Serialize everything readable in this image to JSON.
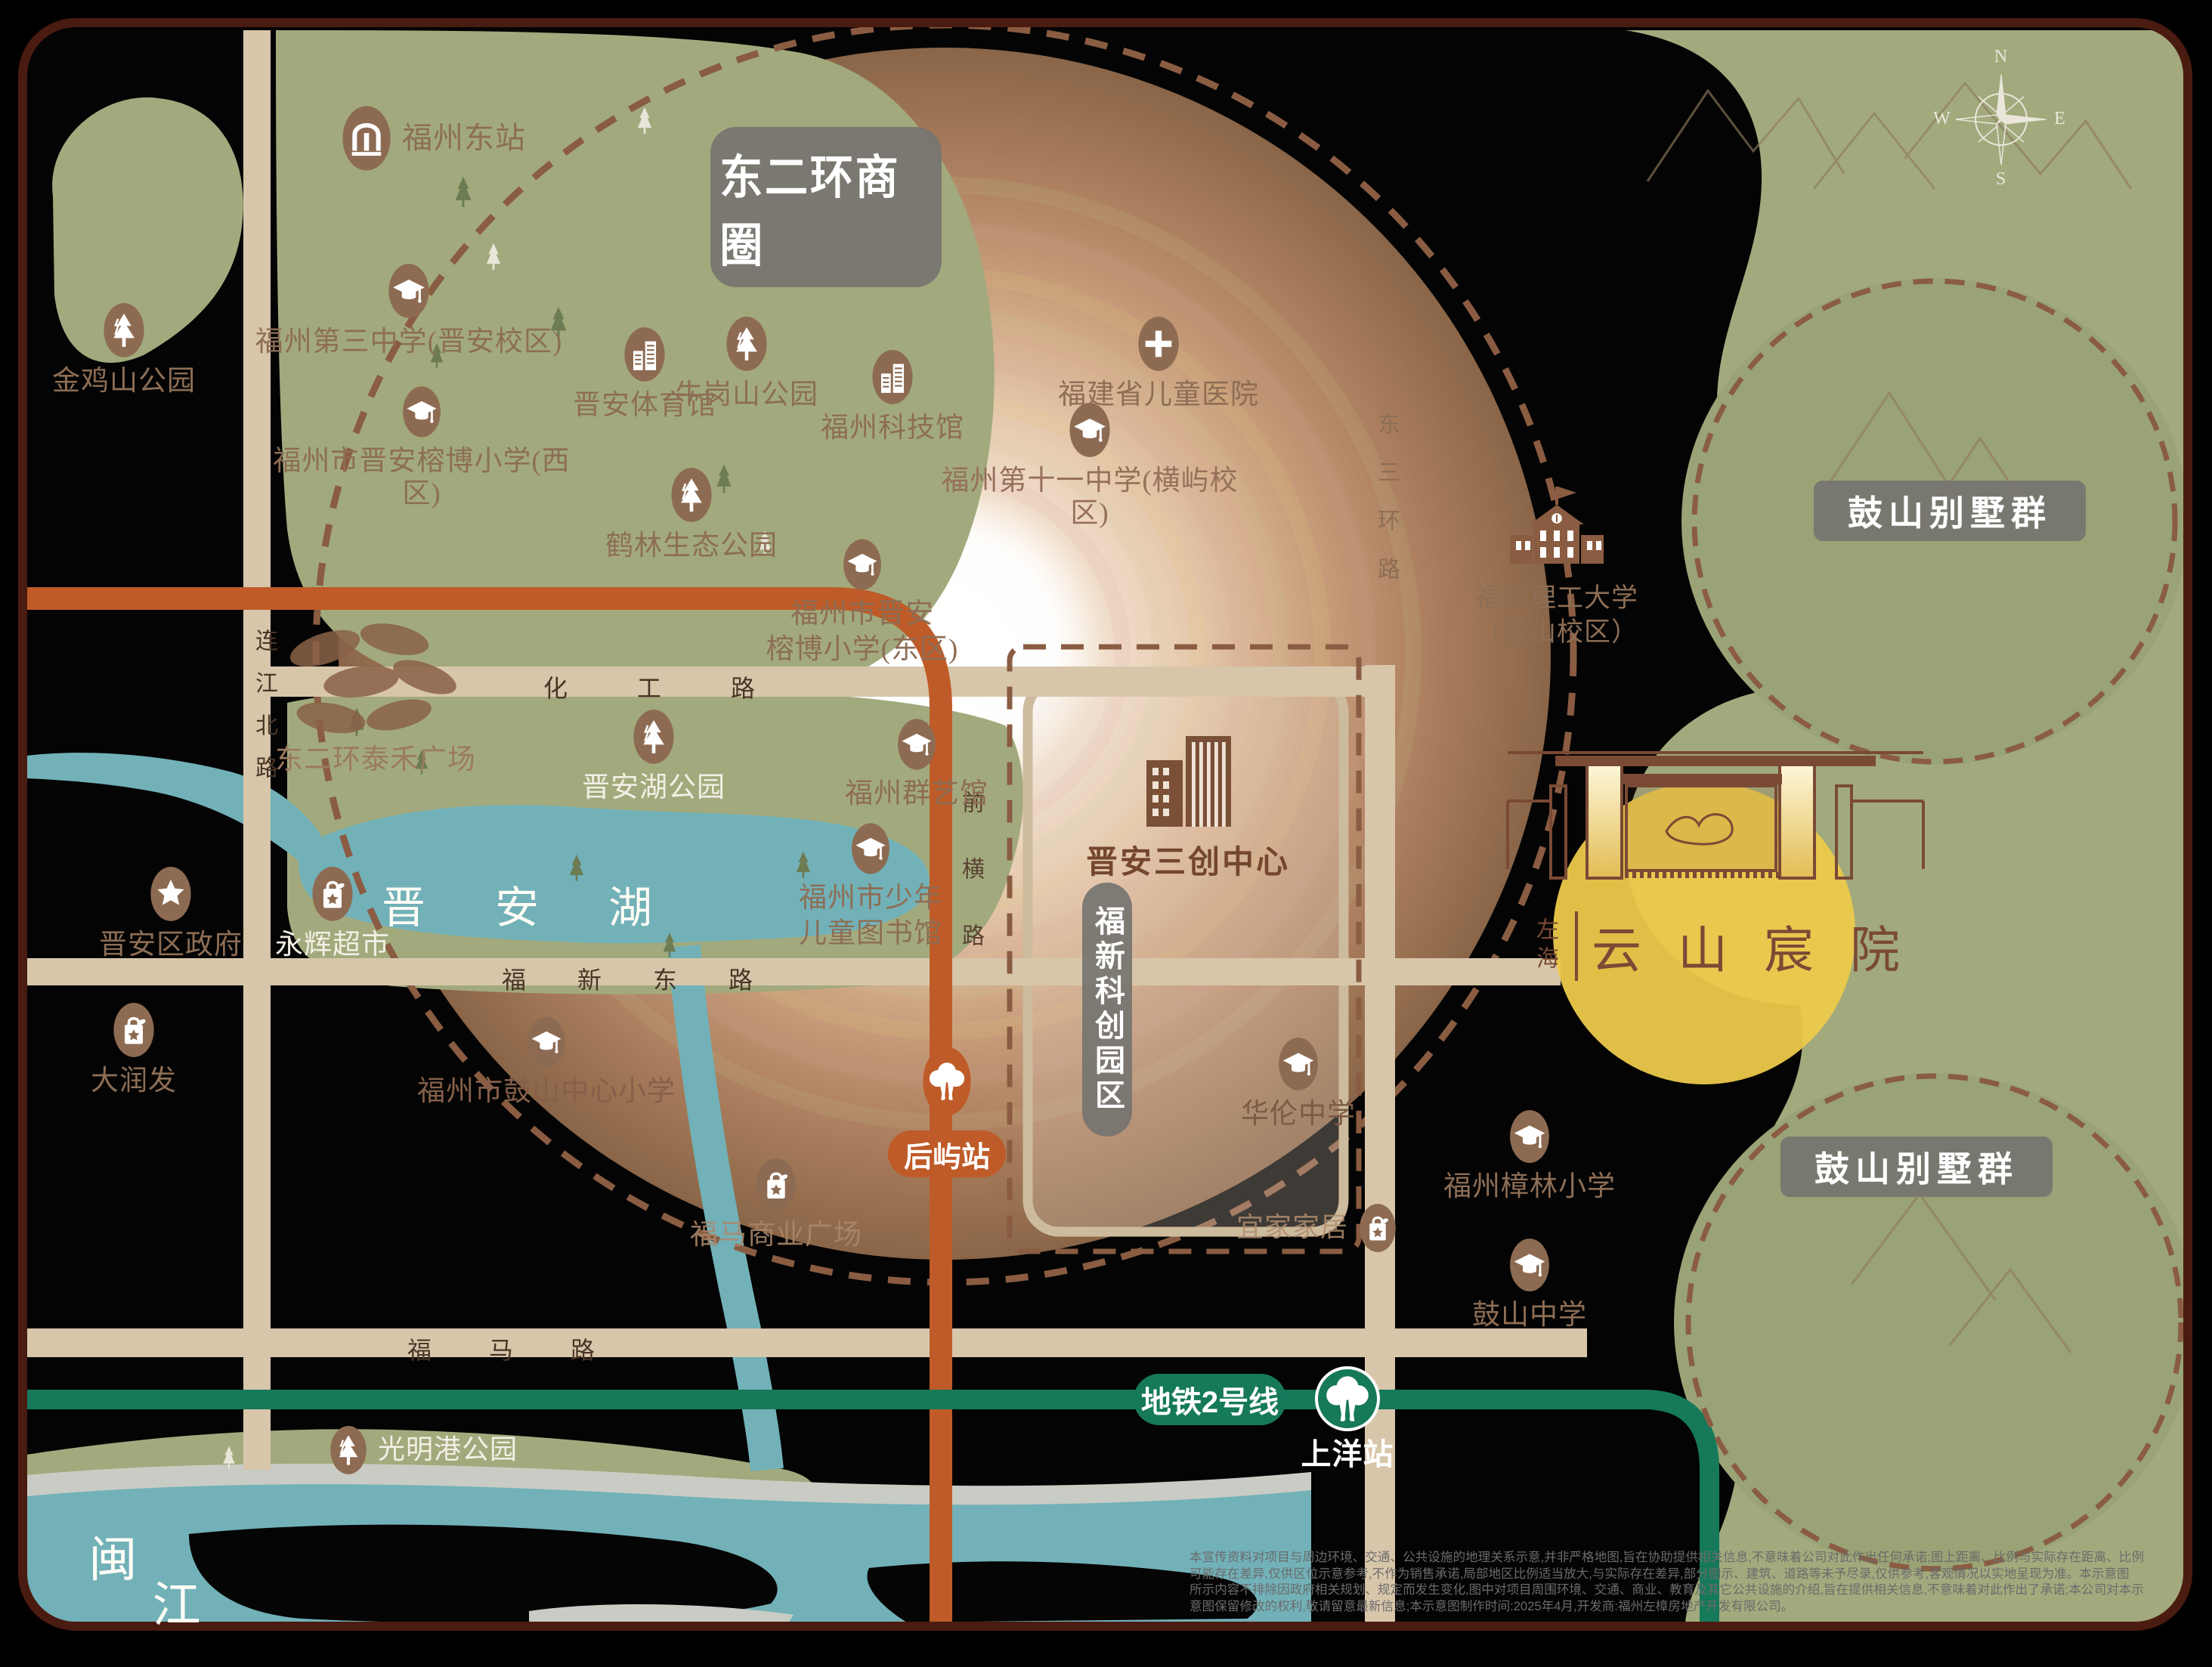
{
  "map": {
    "project": {
      "brand": "左海",
      "name": "云山宸院"
    },
    "badges": {
      "business_circle": "东二环商圈",
      "villas_top": "鼓山别墅群",
      "villas_bottom": "鼓山别墅群",
      "science_park_vertical": "福新科创园区",
      "metro_line": "地铁2号线"
    },
    "stations": {
      "houyu": "后屿站",
      "shangyang": "上洋站"
    },
    "water": {
      "lake": "晋安湖",
      "river_char1": "闽",
      "river_char2": "江"
    },
    "roads": {
      "lianjiang_north": "连江北路",
      "huagong": "化 工 路",
      "fuxin_east": "福 新 东 路",
      "qianheng": "前横路",
      "fuma": "福 马 路",
      "east_third_ring": "东三环路"
    },
    "landmark": {
      "sanchuang": "晋安三创中心"
    },
    "compass": {
      "n": "N",
      "e": "E",
      "s": "S",
      "w": "W"
    },
    "pois": {
      "fuzhou_east_station": {
        "label": "福州东站"
      },
      "jinjishan_park": {
        "label": "金鸡山公园"
      },
      "no3_middle_school": {
        "label": "福州第三中学(晋安校区)"
      },
      "niugangshan_park": {
        "label": "牛岗山公园"
      },
      "science_museum": {
        "label": "福州科技馆"
      },
      "children_hospital": {
        "label": "福建省儿童医院"
      },
      "jinan_gym": {
        "label": "晋安体育馆"
      },
      "rongbo_primary_west": {
        "label": "福州市晋安榕博小学(西区)"
      },
      "helin_eco_park": {
        "label": "鹤林生态公园"
      },
      "no11_middle_school": {
        "label": "福州第十一中学(横屿校区)"
      },
      "taihe_plaza": {
        "label": "东二环泰禾广场"
      },
      "rongbo_primary_east": {
        "line1": "福州市晋安",
        "line2": "榕博小学(东区)"
      },
      "jinanhu_park": {
        "label": "晋安湖公园"
      },
      "qunyi_museum": {
        "label": "福州群艺馆"
      },
      "children_library": {
        "line1": "福州市少年",
        "line2": "儿童图书馆"
      },
      "yonghui_supermarket": {
        "label": "永辉超市"
      },
      "jinan_district_govt": {
        "label": "晋安区政府"
      },
      "darunfa": {
        "label": "大润发"
      },
      "gushan_central_primary": {
        "label": "福州市鼓山中心小学"
      },
      "fuma_plaza": {
        "label": "福马商业广场"
      },
      "hualun_middle_school": {
        "label": "华伦中学"
      },
      "ikea": {
        "label": "宜家家居"
      },
      "zhanglin_primary": {
        "label": "福州樟林小学"
      },
      "gushan_middle_school": {
        "label": "鼓山中学"
      },
      "fujian_tech_university": {
        "line1": "福建理工大学",
        "line2": "（鼓山校区）"
      },
      "guangminggang_park": {
        "label": "光明港公园"
      }
    },
    "disclaimer": {
      "line1": "本宣传资料对项目与周边环境、交通、公共设施的地理关系示意,并非严格地图,旨在协助提供相关信息,不意味着公司对此作出任何承诺;图上距离、比例与实际存在距离、比例",
      "line2": "可能存在差异,仅供区位示意参考,不作为销售承诺,局部地区比例适当放大,与实际存在差异,部分图示、建筑、道路等未予尽录,仅供参考,客观情况以实地呈现为准。本示意图",
      "line3": "所示内容不排除因政府相关规划、规定而发生变化,图中对项目周围环境、交通、商业、教育及其它公共设施的介绍,旨在提供相关信息,不意味着对此作出了承诺;本公司对本示",
      "line4": "意图保留修改的权利,敬请留意最新信息;本示意图制作时间:2025年4月,开发商:福州左樟房地产开发有限公司。"
    },
    "colors": {
      "accent_orange": "#bf5b28",
      "metro_green": "#15795a",
      "map_green": "#a2aa7d",
      "water_teal": "#72b1b8",
      "icon_brown": "#8d6b52",
      "label_brown": "#8d6e55",
      "highlight_yellow": "#ecc94b"
    }
  }
}
